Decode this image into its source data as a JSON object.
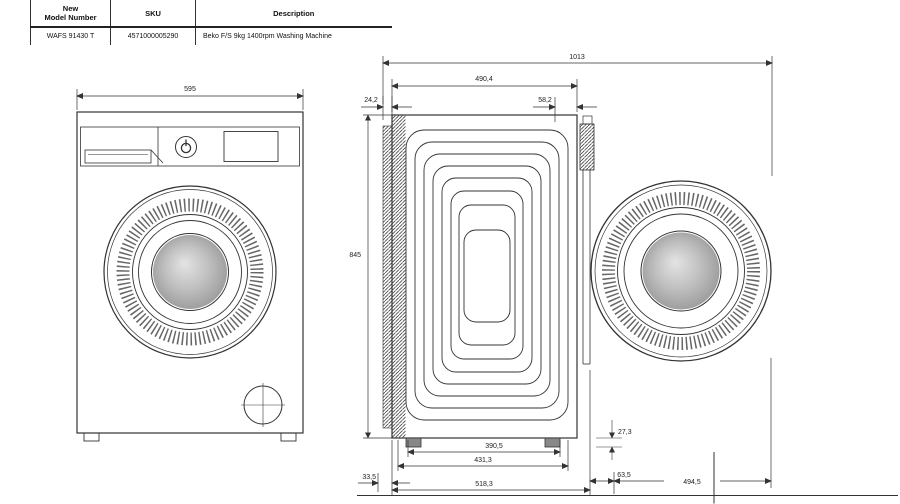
{
  "table": {
    "col1_header_l1": "New",
    "col1_header_l2": "Model Number",
    "col2_header": "SKU",
    "col3_header": "Description",
    "model": "WAFS 91430 T",
    "sku": "4571000005290",
    "description": "Beko F/S 9kg 1400rpm Washing Machine"
  },
  "dims": {
    "front_width": "595",
    "overall_depth": "1013",
    "body_depth": "490,4",
    "rear_offset": "24,2",
    "front_offset": "58,2",
    "height": "845",
    "feet_inner": "390,5",
    "feet_outer": "431,3",
    "base_depth": "518,3",
    "rear_clearance": "33,5",
    "foot_height": "27,3",
    "door_offset": "63,5",
    "door_width": "494,5"
  },
  "colors": {
    "line": "#333333",
    "drum_shade": "#9a9a9a"
  }
}
